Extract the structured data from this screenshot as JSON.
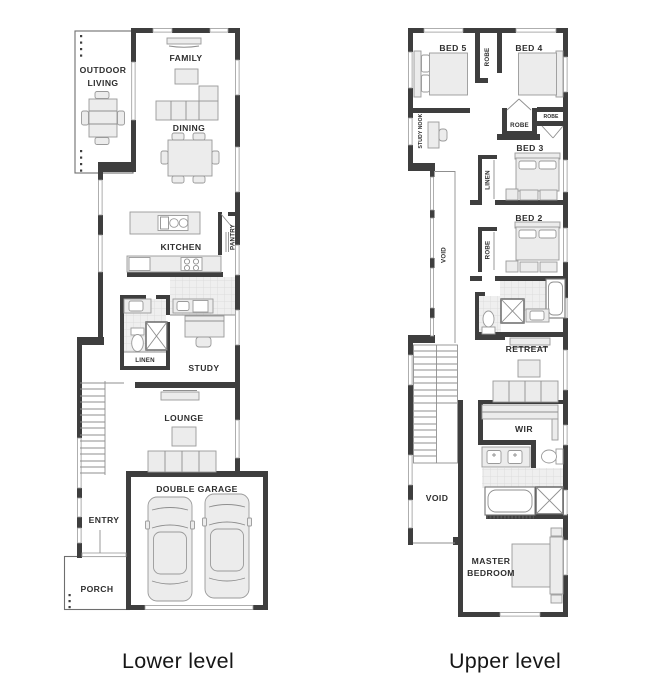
{
  "captions": {
    "lower": "Lower level",
    "upper": "Upper level"
  },
  "colors": {
    "wall": "#3e3e3e",
    "furniture_fill": "#ececec",
    "furniture_stroke": "#9a9a9a",
    "label_ink": "#2e2e2e",
    "caption_ink": "#161616",
    "tile_line": "#d8d8d8"
  },
  "lower_plan": {
    "labels": {
      "outdoor_living_line1": "OUTDOOR",
      "outdoor_living_line2": "LIVING",
      "family": "FAMILY",
      "dining": "DINING",
      "kitchen": "KITCHEN",
      "pantry": "PANTRY",
      "linen": "LINEN",
      "study": "STUDY",
      "lounge": "LOUNGE",
      "double_garage": "DOUBLE GARAGE",
      "entry": "ENTRY",
      "porch": "PORCH"
    }
  },
  "upper_plan": {
    "labels": {
      "bed5": "BED 5",
      "robe_top": "ROBE",
      "bed4": "BED 4",
      "robe_mid_left": "ROBE",
      "robe_mid_right": "ROBE",
      "study_nook": "STUDY NOOK",
      "bed3": "BED 3",
      "linen": "LINEN",
      "bed2": "BED 2",
      "robe_bed2": "ROBE",
      "void_vertical": "VOID",
      "retreat": "RETREAT",
      "wir": "WIR",
      "void_lower": "VOID",
      "master_line1": "MASTER",
      "master_line2": "BEDROOM"
    }
  }
}
